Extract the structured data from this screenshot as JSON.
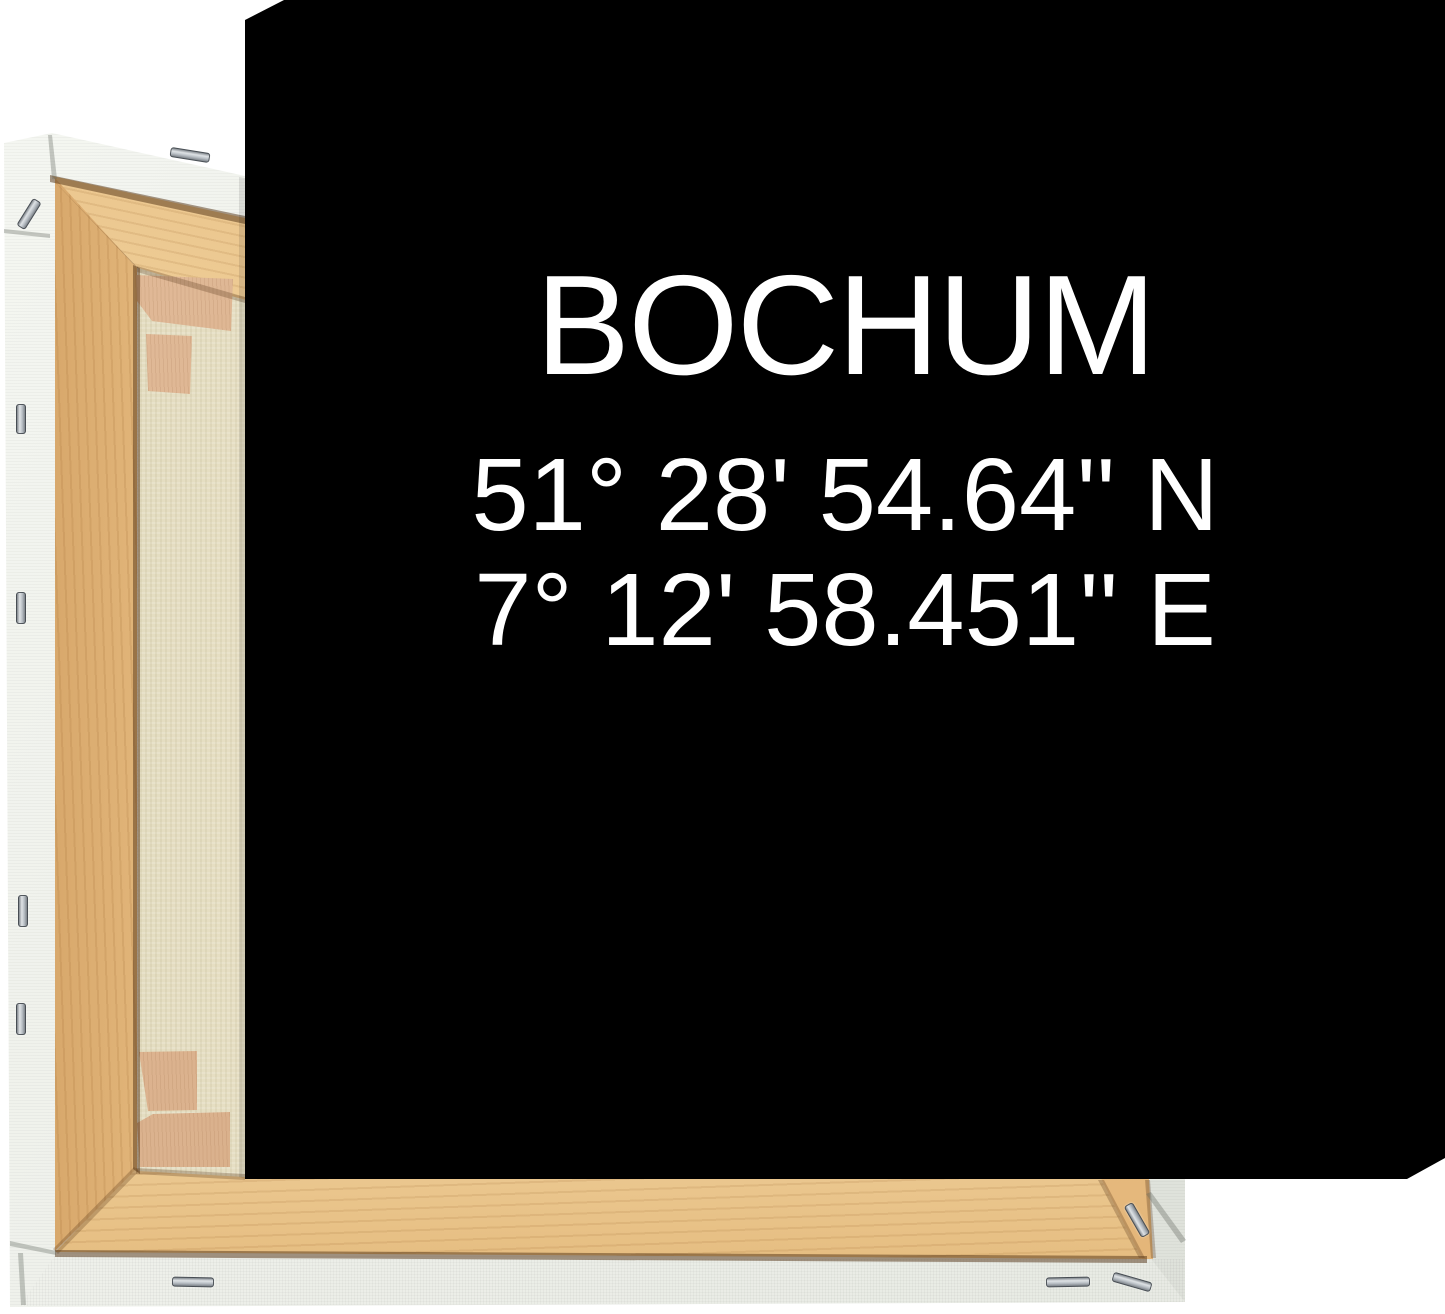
{
  "artwork": {
    "title": "BOCHUM",
    "latitude": "51° 28' 54.64'' N",
    "longitude": "7° 12' 58.451'' E"
  },
  "colors": {
    "print_background": "#000000",
    "print_text": "#FFFFFF",
    "page_background": "#FFFFFF",
    "stretcher_wood": "#ECC58D",
    "corner_wedge_wood": "#DCB492",
    "canvas_back_fabric": "#E6DFC3",
    "canvas_wrap_white": "#EDEFE9",
    "staple_metal": "#C7CCD1"
  }
}
